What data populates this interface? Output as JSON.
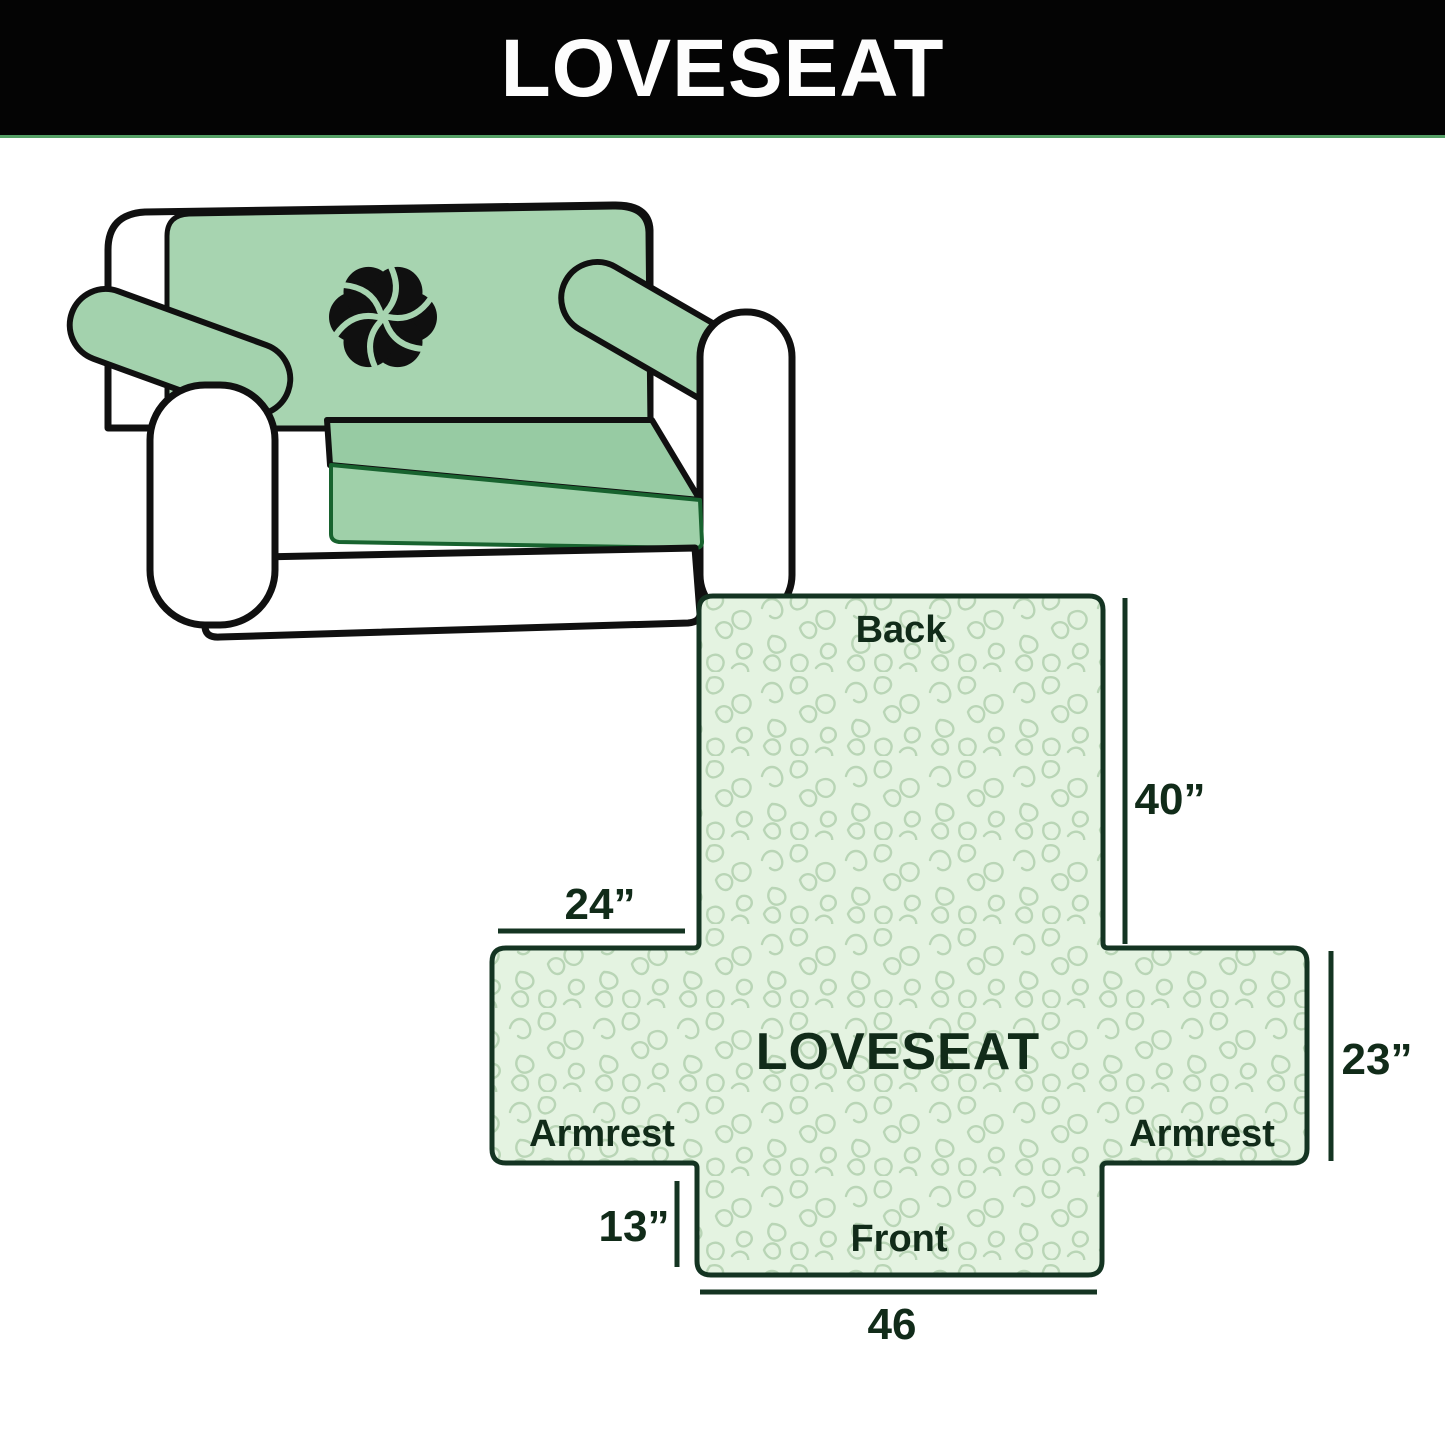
{
  "banner": {
    "title": "LOVESEAT",
    "background_color": "#040404",
    "text_color": "#fdfdfd",
    "underline_color": "#55a066"
  },
  "illustration": {
    "description": "loveseat sofa with mint green slipcover on back, seat and armrests",
    "cover_color": "#a7d4b0",
    "seat_color": "#97cba3",
    "outline_color": "#101010",
    "logo_icon": "pinwheel"
  },
  "diagram": {
    "product_label": "LOVESEAT",
    "back_label": "Back",
    "front_label": "Front",
    "armrest_left_label": "Armrest",
    "armrest_right_label": "Armrest",
    "dim_back_height": "40”",
    "dim_armrest_top_width": "24”",
    "dim_side_height": "23”",
    "dim_front_drop": "13”",
    "dim_front_width": "46",
    "fill_color": "#e4f3e1",
    "pattern_color": "#b9d5b6",
    "line_color": "#143422",
    "text_color": "#112b19"
  }
}
